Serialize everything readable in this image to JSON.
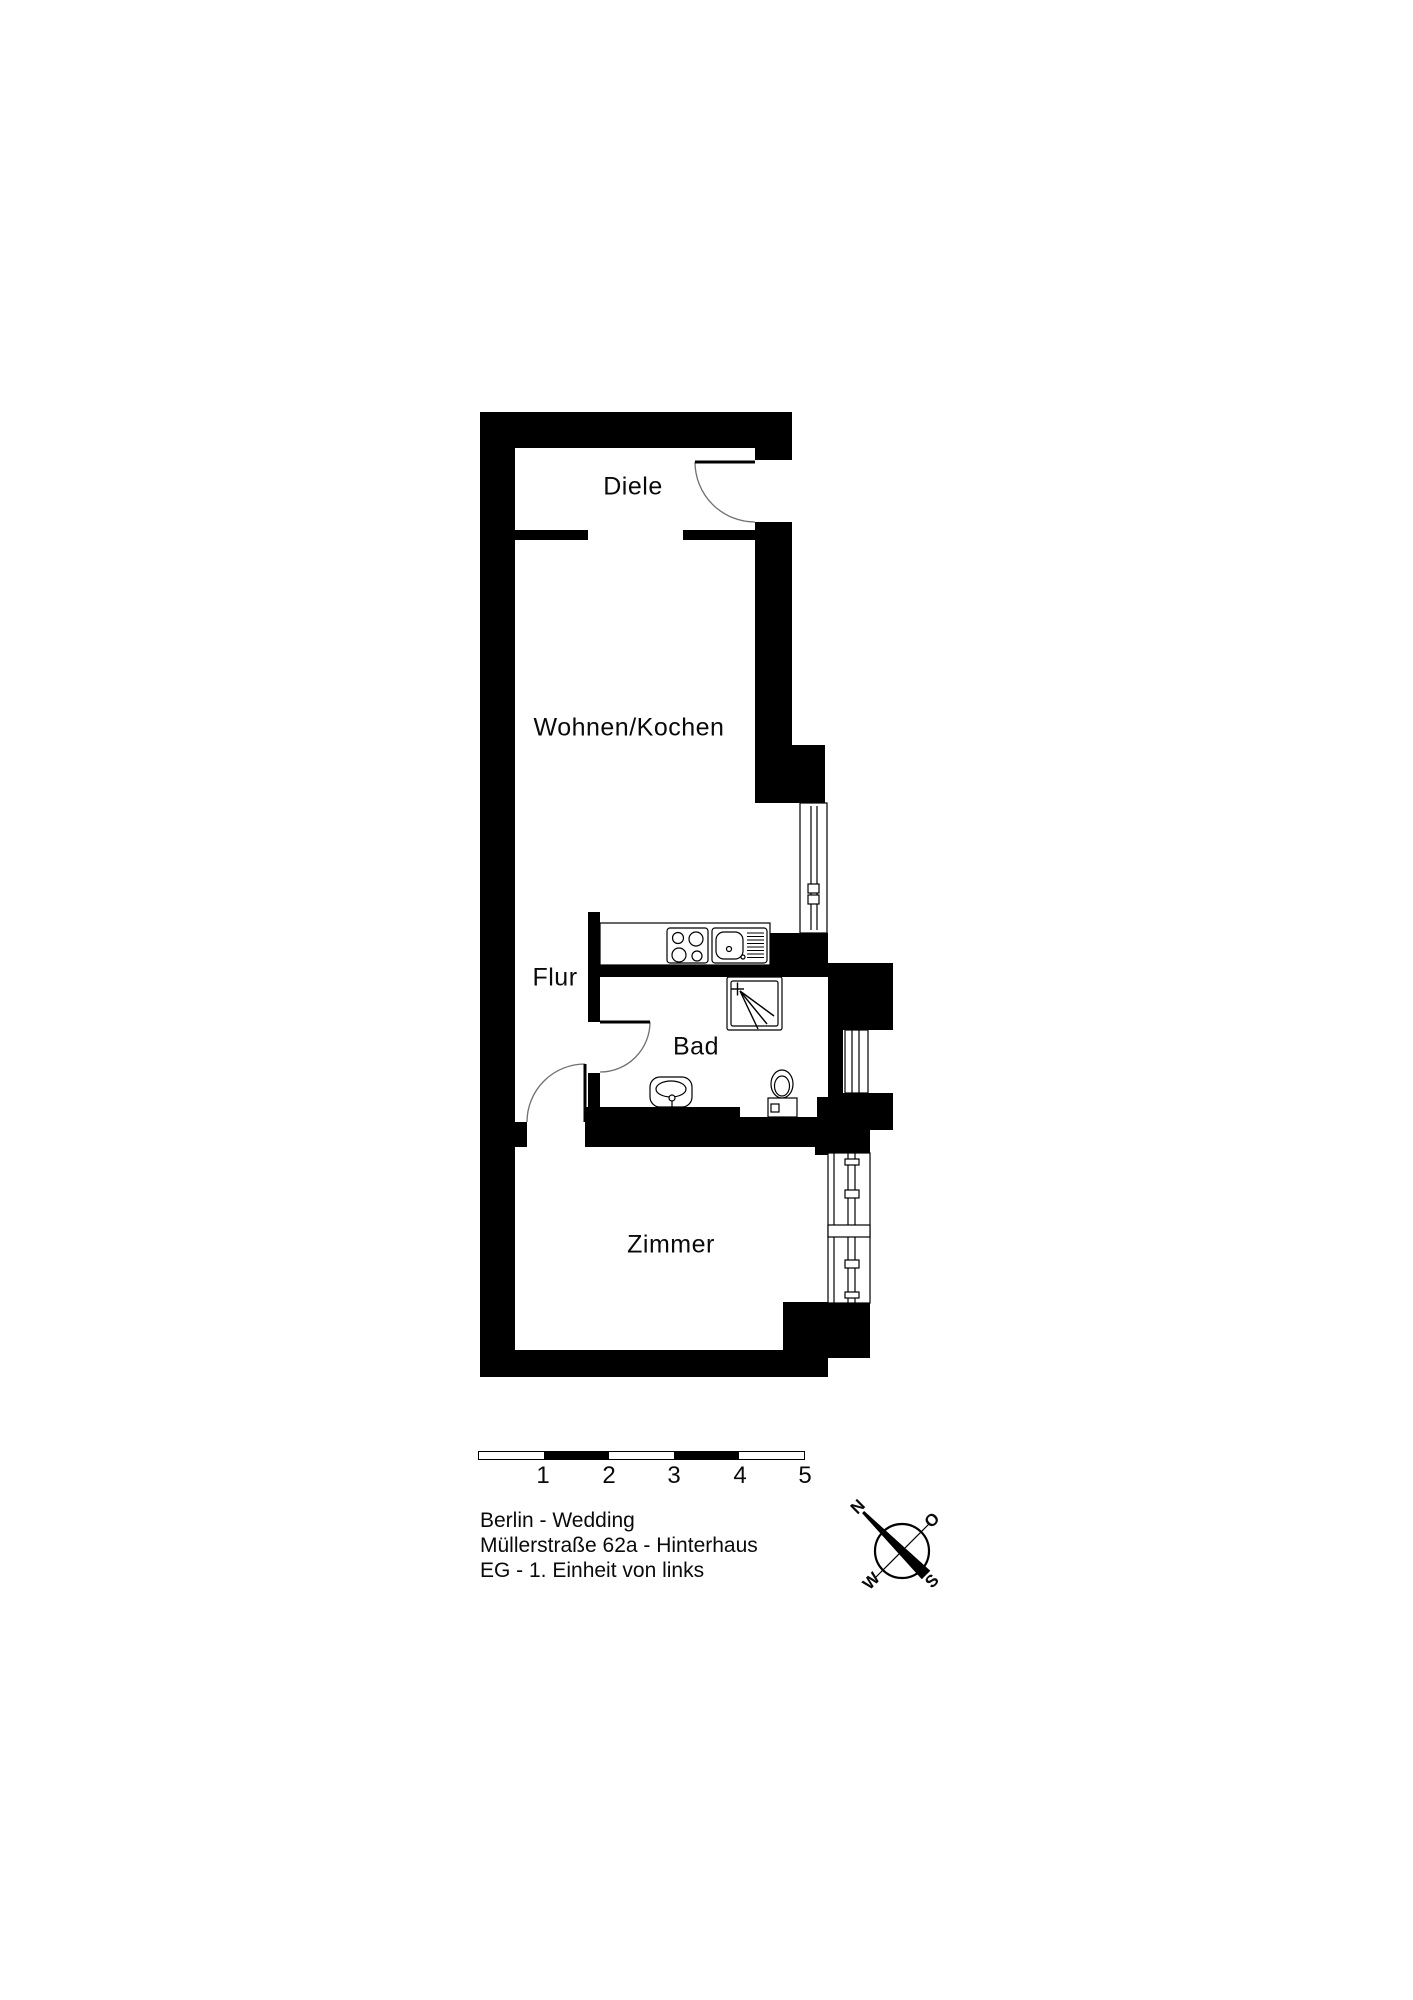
{
  "plan": {
    "rooms": {
      "diele": "Diele",
      "wohnen_kochen": "Wohnen/Kochen",
      "flur": "Flur",
      "bad": "Bad",
      "zimmer": "Zimmer"
    },
    "fixtures": {
      "stove": "stove-icon",
      "sink": "kitchen-sink-icon",
      "shower": "shower-icon",
      "washbasin": "washbasin-icon",
      "toilet": "toilet-icon"
    }
  },
  "scale_bar": {
    "labels": [
      "1",
      "2",
      "3",
      "4",
      "5"
    ]
  },
  "legend": {
    "line1": "Berlin - Wedding",
    "line2": "Müllerstraße 62a - Hinterhaus",
    "line3": "EG - 1. Einheit von links"
  },
  "compass": {
    "north": "N",
    "east": "O",
    "south": "S",
    "west": "W"
  },
  "colors": {
    "wall": "#000000",
    "background": "#ffffff",
    "door_arc": "#707070"
  }
}
